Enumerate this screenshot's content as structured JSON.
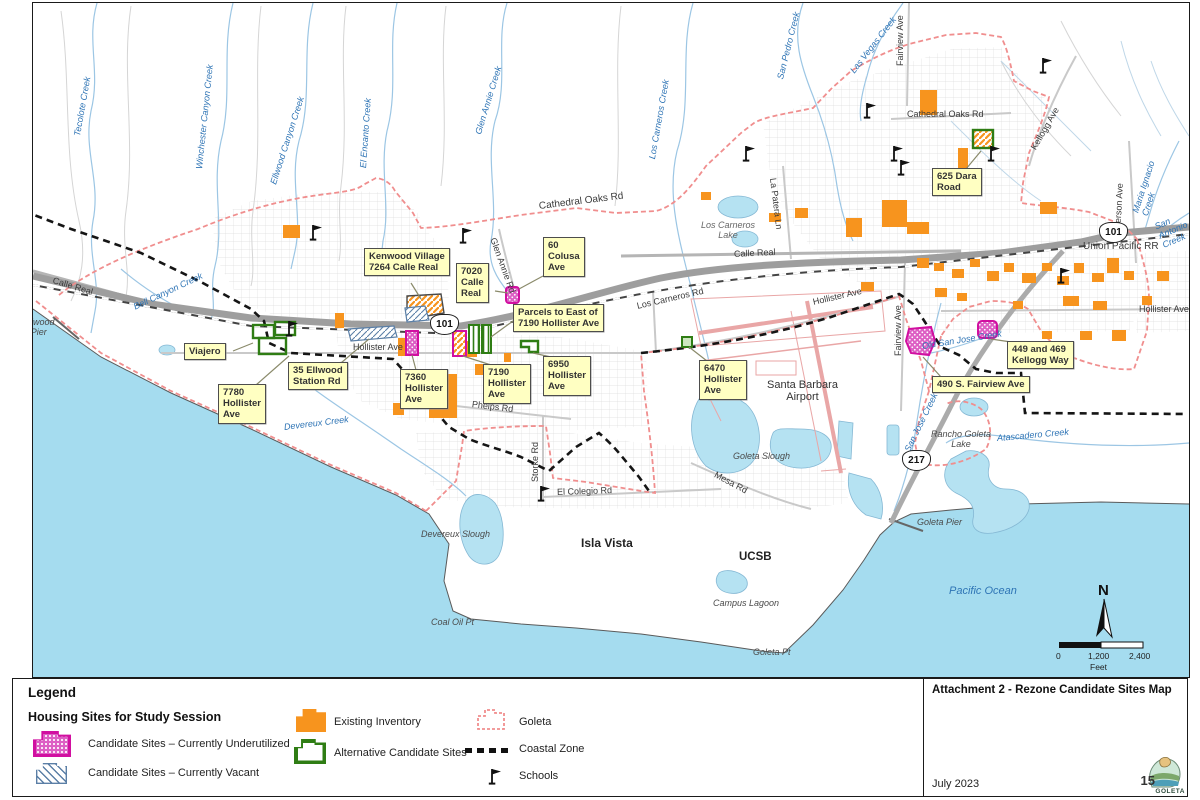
{
  "page": {
    "title": "Attachment 2 - Rezone Candidate Sites Map",
    "date": "July 2023",
    "page_number": "15",
    "logo_text": "GOLETA"
  },
  "legend": {
    "heading": "Legend",
    "subheading": "Housing Sites for Study Session",
    "items": [
      {
        "label": "Candidate Sites – Currently Underutilized",
        "swatch": "magenta-dotted"
      },
      {
        "label": "Candidate Sites – Currently Vacant",
        "swatch": "blue-hatched"
      },
      {
        "label": "Existing Inventory",
        "swatch": "orange-fill"
      },
      {
        "label": "Alternative Candidate Sites",
        "swatch": "green-outline"
      },
      {
        "label": "Goleta",
        "swatch": "red-dashed-outline"
      },
      {
        "label": "Coastal Zone",
        "swatch": "black-dashed-line"
      },
      {
        "label": "Schools",
        "swatch": "flag-icon"
      }
    ],
    "colors": {
      "underutilized": "#D10FA0",
      "vacant_hatch": "#5B7FA6",
      "existing_inventory": "#F7941E",
      "alternative": "#2F7D14",
      "goleta_boundary": "#F08E8E",
      "coastal_zone": "#111111",
      "ocean": "#A5DCEF"
    }
  },
  "compass": {
    "label": "N"
  },
  "scale_bar": {
    "ticks": [
      "0",
      "1,200",
      "2,400"
    ],
    "unit": "Feet"
  },
  "highways": [
    {
      "num": "101"
    },
    {
      "num": "101"
    },
    {
      "num": "217"
    }
  ],
  "sites": [
    {
      "label": "Kenwood Village\n7264 Calle Real"
    },
    {
      "label": "7020\nCalle\nReal"
    },
    {
      "label": "60\nColusa\nAve"
    },
    {
      "label": "Parcels to East of\n7190 Hollister Ave"
    },
    {
      "label": "Viajero"
    },
    {
      "label": "35 Ellwood\nStation Rd"
    },
    {
      "label": "7780\nHollister\nAve"
    },
    {
      "label": "7360\nHollister\nAve"
    },
    {
      "label": "7190\nHollister\nAve"
    },
    {
      "label": "6950\nHollister\nAve"
    },
    {
      "label": "6470\nHollister\nAve"
    },
    {
      "label": "625 Dara\nRoad"
    },
    {
      "label": "449 and 469\nKellogg Way"
    },
    {
      "label": "490 S. Fairview Ave"
    }
  ],
  "roads": [
    {
      "name": "Cathedral Oaks Rd"
    },
    {
      "name": "Cathedral Oaks Rd"
    },
    {
      "name": "Calle Real"
    },
    {
      "name": "Calle Real"
    },
    {
      "name": "Union Pacific RR"
    },
    {
      "name": "Hollister Ave"
    },
    {
      "name": "Hollister Ave"
    },
    {
      "name": "Hollister Ave"
    },
    {
      "name": "Los Carneros Rd"
    },
    {
      "name": "Fairview Ave"
    },
    {
      "name": "Fairview Ave"
    },
    {
      "name": "Kellogg Ave"
    },
    {
      "name": "Patterson Ave"
    },
    {
      "name": "La Patera Ln"
    },
    {
      "name": "Glen Annie Rd"
    },
    {
      "name": "Storke Rd"
    },
    {
      "name": "El Colegio Rd"
    },
    {
      "name": "Mesa Rd"
    },
    {
      "name": "Phelps Rd"
    }
  ],
  "water": [
    {
      "name": "Tecolote Creek"
    },
    {
      "name": "Winchester Canyon Creek"
    },
    {
      "name": "Ellwood Canyon Creek"
    },
    {
      "name": "El Encanto Creek"
    },
    {
      "name": "Glen Annie Creek"
    },
    {
      "name": "Los Carneros Creek"
    },
    {
      "name": "San Pedro Creek"
    },
    {
      "name": "Las Vegas Creek"
    },
    {
      "name": "Maria Ignacio Creek"
    },
    {
      "name": "San Antonio Creek"
    },
    {
      "name": "Bell Canyon Creek"
    },
    {
      "name": "Devereux Creek"
    },
    {
      "name": "San Jose Creek"
    },
    {
      "name": "Old San Jose Creek"
    },
    {
      "name": "Atascadero Creek"
    },
    {
      "name": "Pacific Ocean"
    }
  ],
  "places": [
    {
      "name": "Ellwood\nPier"
    },
    {
      "name": "Los Carneros\nLake"
    },
    {
      "name": "Santa Barbara\nAirport"
    },
    {
      "name": "Goleta Slough"
    },
    {
      "name": "Devereux Slough"
    },
    {
      "name": "Isla Vista"
    },
    {
      "name": "UCSB"
    },
    {
      "name": "Campus Lagoon"
    },
    {
      "name": "Coal Oil Pt"
    },
    {
      "name": "Goleta Pt"
    },
    {
      "name": "Goleta Pier"
    },
    {
      "name": "Rancho Goleta\nLake"
    }
  ]
}
